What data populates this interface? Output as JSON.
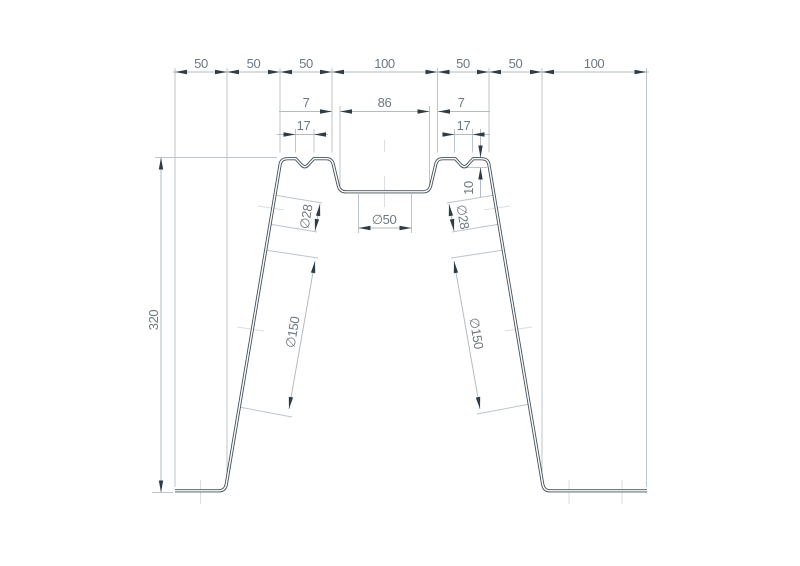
{
  "drawing": {
    "type": "technical-profile-cross-section",
    "dims": {
      "top_chain": [
        "50",
        "50",
        "50",
        "100",
        "50",
        "50",
        "100"
      ],
      "opening": [
        "7",
        "86",
        "7"
      ],
      "notch_widths": [
        "17",
        "17"
      ],
      "notch_depth": "10",
      "overall_height": "320",
      "center_hole": "∅50",
      "upper_holes": [
        "∅28",
        "∅28"
      ],
      "lower_holes": [
        "∅150",
        "∅150"
      ]
    },
    "colors": {
      "background": "#ffffff",
      "profile_line": "#42505a",
      "dimension_line": "#b2bcc2",
      "extension_line": "#bcc5cb",
      "centerline": "#d8dee2",
      "arrow": "#2e3c46",
      "text": "#6e7880"
    }
  }
}
